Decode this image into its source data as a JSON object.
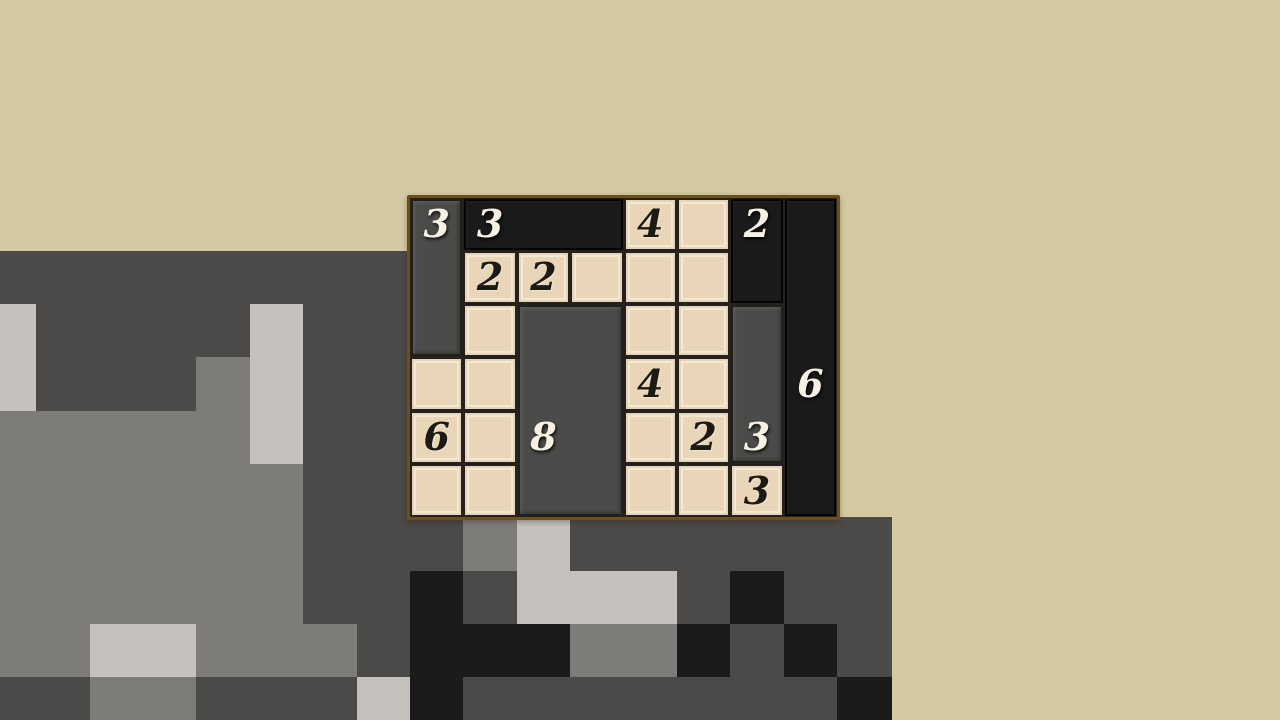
{
  "scene": {
    "width": 1280,
    "height": 720,
    "background_color": "#d5c9a2"
  },
  "background_mosaic": {
    "description": "pixelated gray mosaic backdrop",
    "tile_width": 53.4,
    "tile_height": 53.3,
    "origin_x": -17.2,
    "origin_y": -15.7,
    "first_row": 5,
    "palette": {
      "D": "#4b4a48",
      "M": "#7d7c79",
      "L": "#c5c1bd",
      "K": "#1b1b1b"
    },
    "rows": [
      "DDDDDDDD--------T",
      "LDDDDLDD--------T",
      "LDDDMLDD--------T",
      "MMMMMLDD--------T",
      "MMMMMMDD--------T",
      "MMMMMMDDDMLDDDDDD",
      "MMMMMMDDKDLLLDKDD",
      "MMLLMMMDKKKMMKDKD",
      "DDMMDDDLKDDDDDDDK"
    ]
  },
  "puzzle": {
    "left": 410,
    "top": 197.5,
    "cols": 8,
    "rows": 6,
    "cell_width": 53.375,
    "cell_height": 53.3,
    "border_width": 3,
    "border_color": "#6e4e1d",
    "grid_line_color": "#26211a",
    "cell_color": "#e9d6b8",
    "clue_color": "#1d1a15",
    "piece_number_color": "#f6f1e4",
    "piece_colors": {
      "gray": "#4b4b4a",
      "black": "#1a1a1a"
    },
    "clues": [
      {
        "col": 4,
        "row": 0,
        "value": "4"
      },
      {
        "col": 1,
        "row": 1,
        "value": "2"
      },
      {
        "col": 2,
        "row": 1,
        "value": "2"
      },
      {
        "col": 4,
        "row": 3,
        "value": "4"
      },
      {
        "col": 0,
        "row": 4,
        "value": "6"
      },
      {
        "col": 5,
        "row": 4,
        "value": "2"
      },
      {
        "col": 6,
        "row": 5,
        "value": "3"
      }
    ],
    "pieces": [
      {
        "col": 0,
        "row": 0,
        "w": 1,
        "h": 3,
        "tone": "gray",
        "value": "3",
        "num_col": 0,
        "num_row": 0
      },
      {
        "col": 1,
        "row": 0,
        "w": 3,
        "h": 1,
        "tone": "black",
        "value": "3",
        "num_col": 1,
        "num_row": 0
      },
      {
        "col": 6,
        "row": 0,
        "w": 1,
        "h": 2,
        "tone": "black",
        "value": "2",
        "num_col": 6,
        "num_row": 0
      },
      {
        "col": 7,
        "row": 0,
        "w": 1,
        "h": 6,
        "tone": "black",
        "value": "6",
        "num_col": 7,
        "num_row": 3
      },
      {
        "col": 2,
        "row": 2,
        "w": 2,
        "h": 4,
        "tone": "gray",
        "value": "8",
        "num_col": 2,
        "num_row": 4
      },
      {
        "col": 6,
        "row": 2,
        "w": 1,
        "h": 3,
        "tone": "gray",
        "value": "3",
        "num_col": 6,
        "num_row": 4
      }
    ]
  }
}
